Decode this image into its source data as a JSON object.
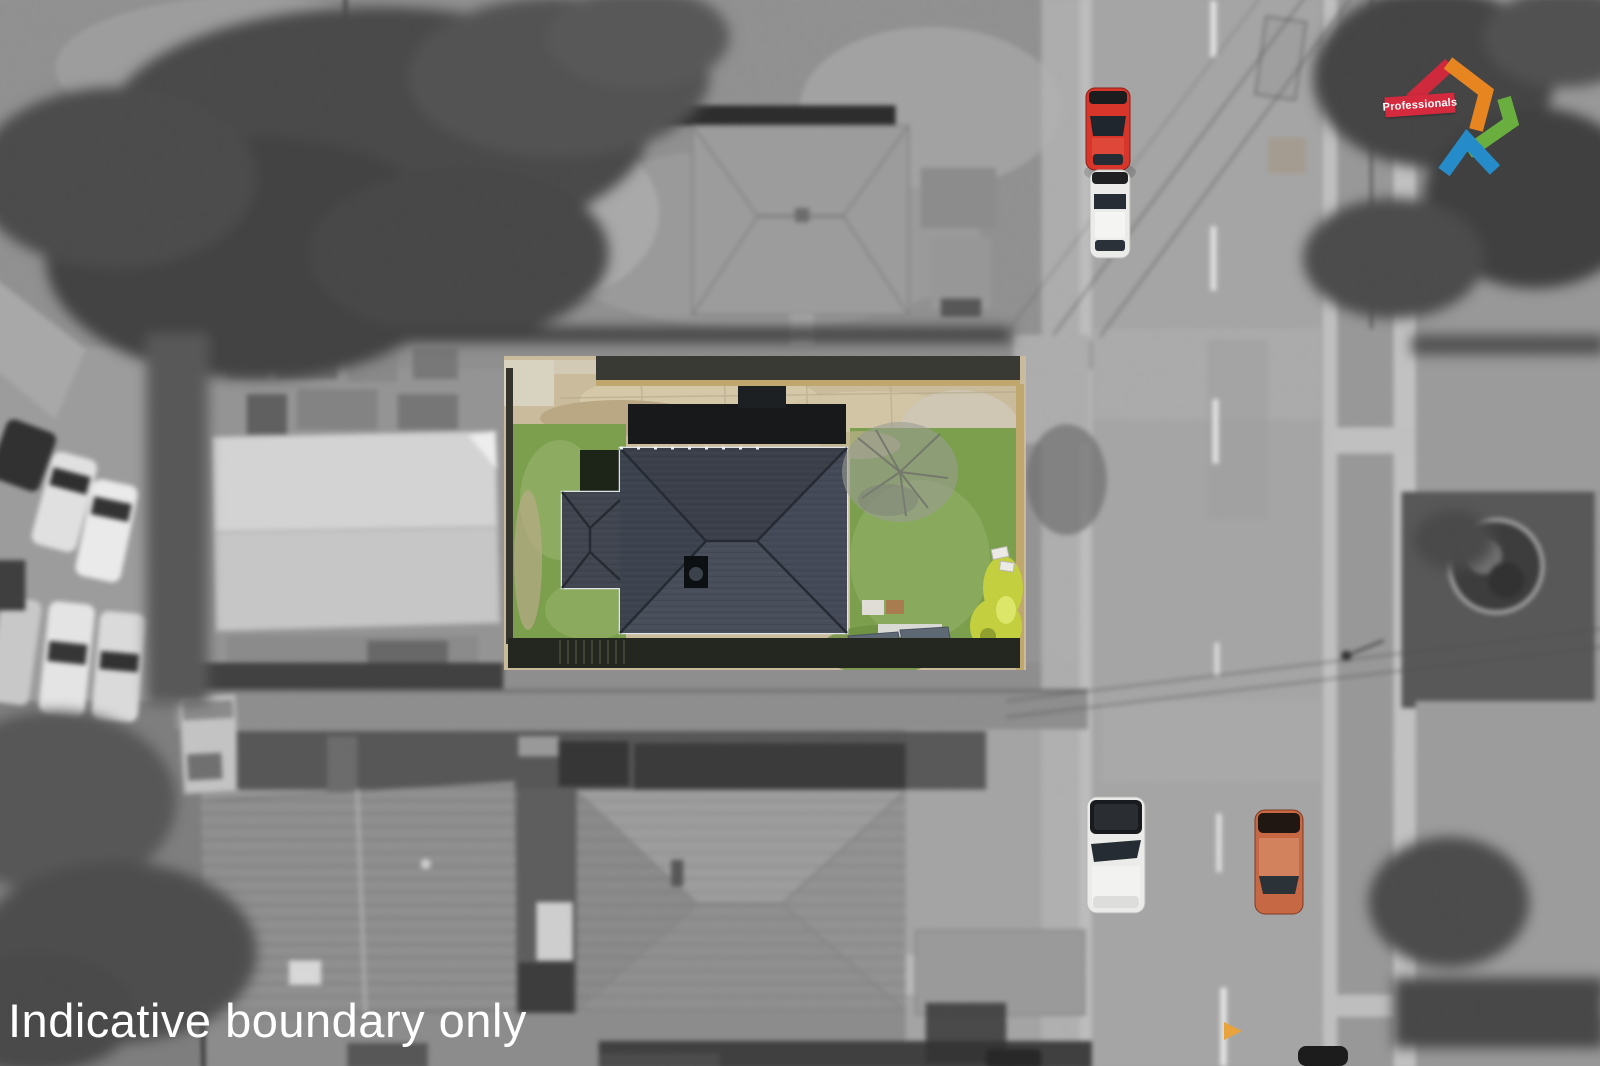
{
  "caption": {
    "text": "Indicative boundary only"
  },
  "watermark": {
    "brand": "Professionals"
  },
  "colors": {
    "lawn": "#7b9f4d",
    "lawn_light": "#96b26a",
    "dirt": "#c9bb9b",
    "concrete_pad": "#d8d2c0",
    "roof_slate": "#3f4450",
    "roof_slate_dark": "#3a3f4a",
    "roof_slate_light": "#474d59",
    "roof_ridge": "#262b33",
    "gutter_white": "#dfe4e9",
    "shed_dark": "#17191b",
    "fence_tan": "#c0a76e",
    "hedge_dark": "#24271f",
    "bush_yellow": "#c3cf3e",
    "furniture_gray": "#5f6974",
    "road": "#a5a5a5",
    "road_line": "#ececec",
    "road_arrow_orange": "#e8a33c",
    "car_red": "#d8352b",
    "car_white": "#ebecea",
    "car_orange": "#c76844",
    "logo_red": "#d5293d",
    "logo_orange": "#ef8a21",
    "logo_green": "#6cb33f",
    "logo_blue": "#268fd0"
  }
}
